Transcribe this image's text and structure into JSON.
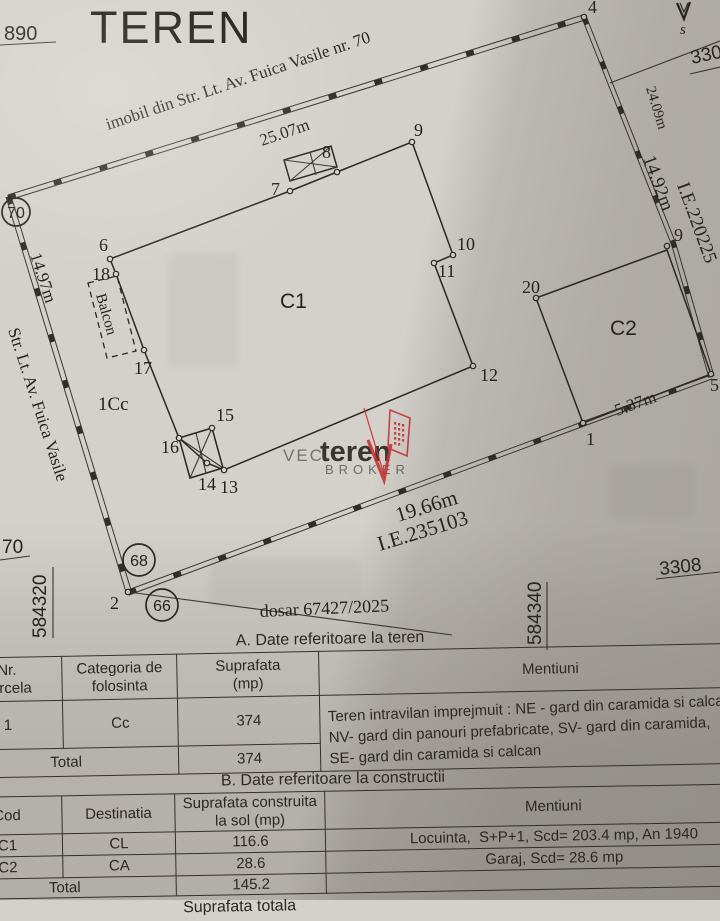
{
  "title": "TEREN",
  "plan": {
    "street_label": "imobil din Str. Lt. Av. Fuica Vasile nr. 70",
    "street_side": "Str. Lt. Av. Fuica Vasile",
    "dim_top": "25.07m",
    "dim_left": "14.97m",
    "dim_right_upper": "24.09m",
    "dim_right_lower": "14.92m",
    "dim_bottom": "19.66m",
    "dim_c2": "5.37m",
    "ie_right": "I.E.220225",
    "ie_bottom": "I.E.235103",
    "dosar": "dosar 67427/2025",
    "compass": "s",
    "coord_top_left": "890",
    "coord_top_right": "330",
    "coord_left_vertical": "584320",
    "coord_left_bottom": "70",
    "coord_bottom_vertical": "584340",
    "coord_bottom_right": "3308",
    "circle_street": "70",
    "circle_68": "68",
    "circle_66": "66",
    "label_c1": "C1",
    "label_c2": "C2",
    "label_parcel": "1Cc",
    "label_balcony": "Balcon",
    "points": {
      "p1": "1",
      "p2": "2",
      "p4": "4",
      "p5": "5",
      "p6": "6",
      "p7": "7",
      "p8": "8",
      "p9a": "9",
      "p9b": "9",
      "p10": "10",
      "p11": "11",
      "p12": "12",
      "p13": "13",
      "p14": "14",
      "p15": "15",
      "p16": "16",
      "p17": "17",
      "p18": "18",
      "p20": "20"
    }
  },
  "watermark": {
    "prefix": "VEC",
    "brand": "teren",
    "suffix": "BROKER"
  },
  "table_a": {
    "caption": "A. Date referitoare la teren",
    "col_nr": "Nr.\nparcela",
    "col_cat": "Categoria de\nfolosinta",
    "col_sup": "Suprafata\n(mp)",
    "col_ment": "Mentiuni",
    "row_nr": "1",
    "row_cat": "Cc",
    "row_sup": "374",
    "row_ment": "Teren intravilan imprejmuit : NE - gard din caramida si calcan,\nNV- gard din panouri prefabricate, SV- gard din caramida,\nSE- gard din caramida si calcan",
    "total_label": "Total",
    "total_sup": "374"
  },
  "table_b": {
    "caption": "B. Date referitoare la constructii",
    "col_cod": "Cod",
    "col_dest": "Destinatia",
    "col_sup": "Suprafata construita\nla sol (mp)",
    "col_ment": "Mentiuni",
    "rows": [
      {
        "cod": "C1",
        "dest": "CL",
        "sup": "116.6",
        "ment": "Locuinta,  S+P+1, Scd= 203.4 mp, An 1940"
      },
      {
        "cod": "C2",
        "dest": "CA",
        "sup": "28.6",
        "ment": "Garaj, Scd= 28.6 mp"
      }
    ],
    "total_label": "Total",
    "total_sup": "145.2",
    "footer": "Suprafata totala"
  }
}
